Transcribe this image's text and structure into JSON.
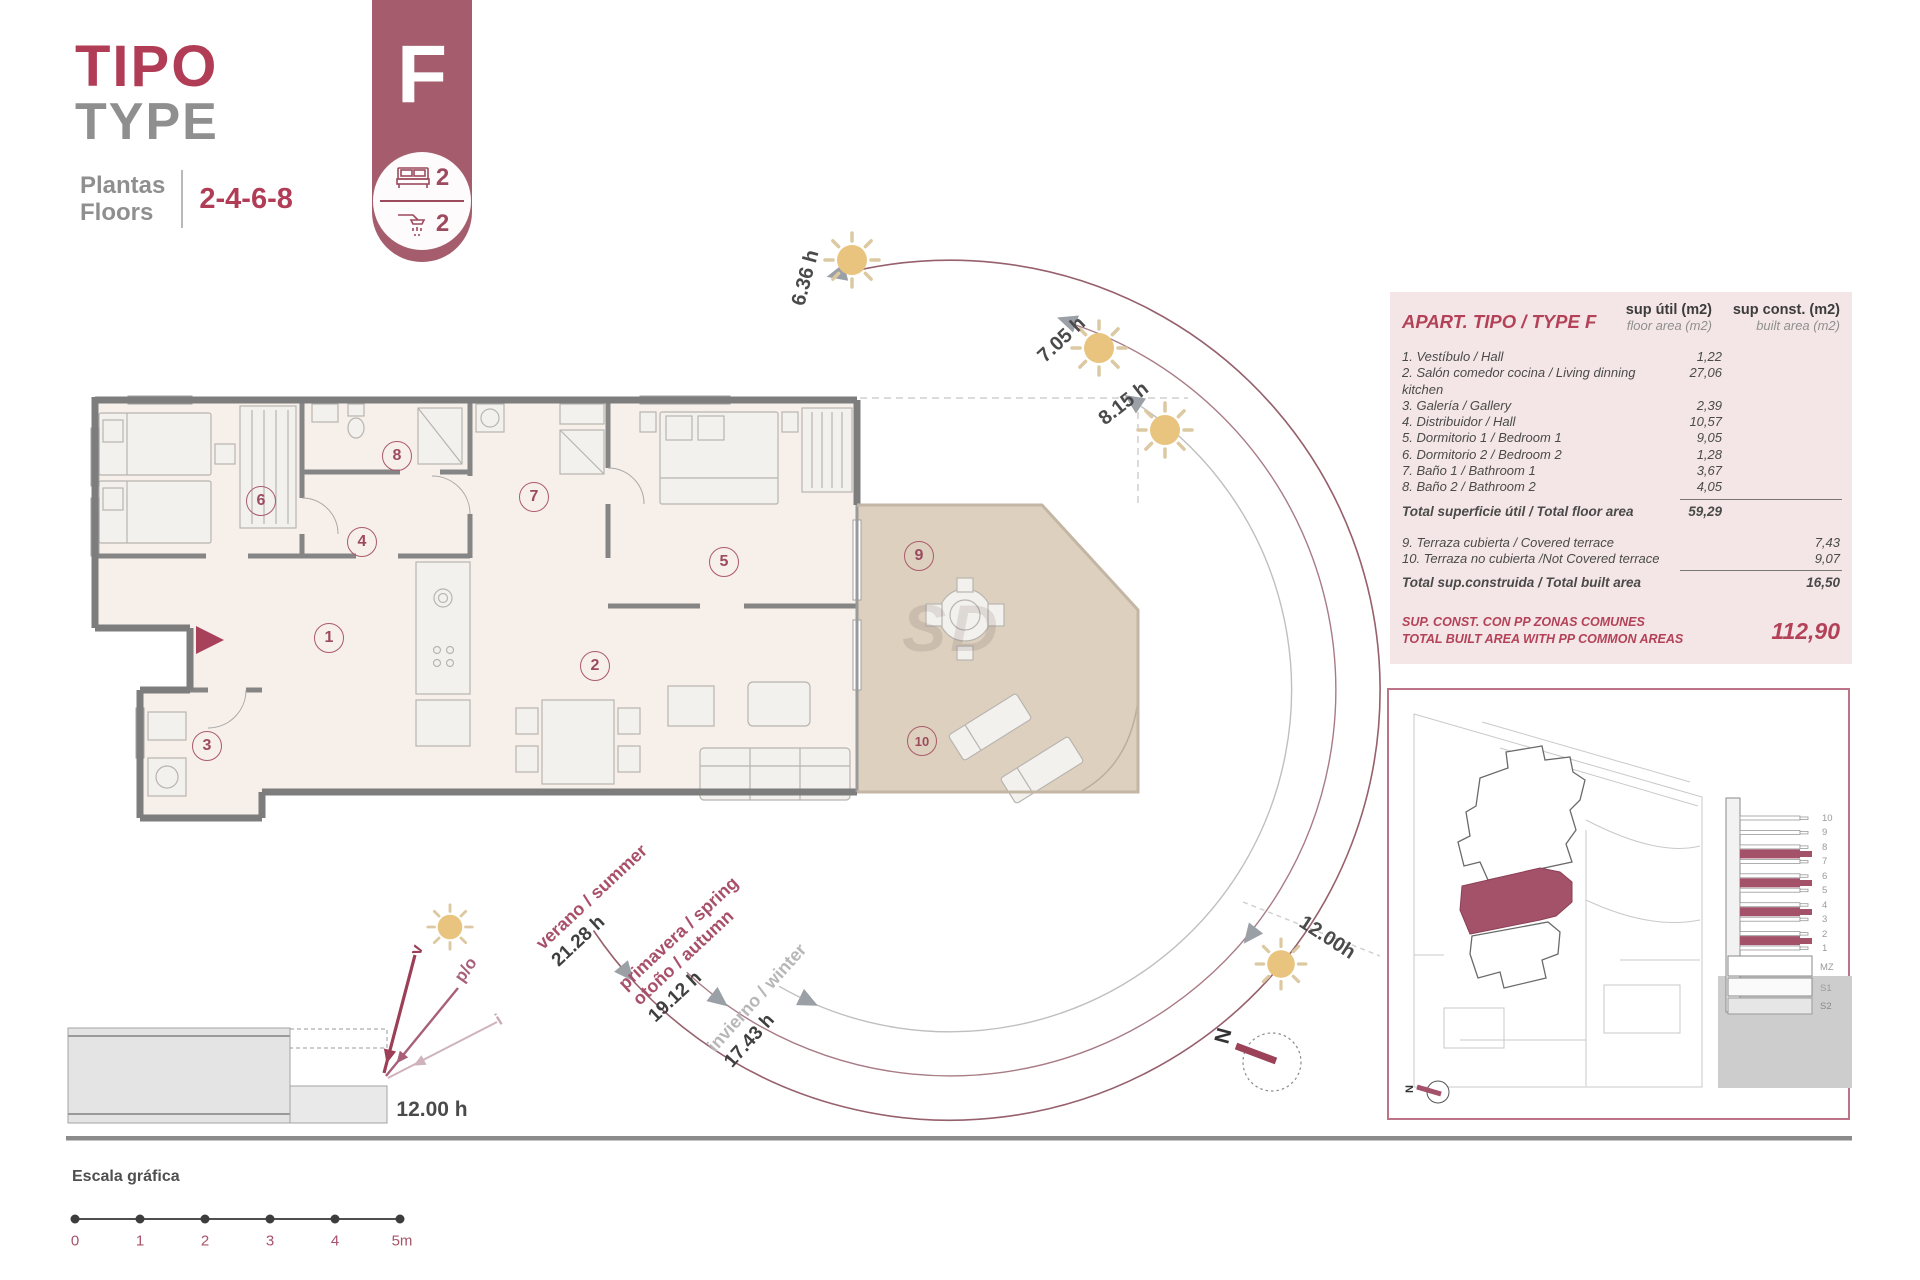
{
  "document": {
    "type_label_es": "TIPO",
    "type_label_en": "TYPE",
    "floors_label_es": "Plantas",
    "floors_label_en": "Floors",
    "floors_value": "2-4-6-8"
  },
  "badge": {
    "letter": "F",
    "bedrooms": "2",
    "bathrooms": "2"
  },
  "floor_plan": {
    "rooms": [
      "1",
      "2",
      "3",
      "4",
      "5",
      "6",
      "7",
      "8",
      "9",
      "10"
    ],
    "watermark": "SD"
  },
  "sun_path": {
    "time_labels": [
      "6.36 h",
      "7.05 h",
      "8.15 h",
      "12.00h"
    ],
    "seasons": [
      {
        "name": "verano / summer",
        "hours": "21.28 h"
      },
      {
        "name": "primavera / spring",
        "name2": "otoño / autumn",
        "hours": "19.12 h"
      },
      {
        "name": "invierno / winter",
        "hours": "17.43 h"
      }
    ]
  },
  "section_diagram": {
    "label_summer": "v",
    "label_spring_autumn": "p/o",
    "label_winter": "i",
    "time": "12.00 h"
  },
  "area_table": {
    "title": "APART. TIPO / TYPE F",
    "col_floor_header": "sup útil (m2)",
    "col_floor_subheader": "floor area (m2)",
    "col_built_header": "sup const. (m2)",
    "col_built_subheader": "built area (m2)",
    "rows": [
      {
        "label": "1. Vestíbulo / Hall",
        "floor": "1,22"
      },
      {
        "label": "2. Salón comedor cocina / Living dinning kitchen",
        "floor": "27,06"
      },
      {
        "label": "3. Galería / Gallery",
        "floor": "2,39"
      },
      {
        "label": "4. Distribuidor / Hall",
        "floor": "10,57"
      },
      {
        "label": "5. Dormitorio 1 / Bedroom 1",
        "floor": "9,05"
      },
      {
        "label": "6. Dormitorio 2 / Bedroom 2",
        "floor": "1,28"
      },
      {
        "label": "7. Baño 1 / Bathroom 1",
        "floor": "3,67"
      },
      {
        "label": "8. Baño 2 / Bathroom 2",
        "floor": "4,05"
      }
    ],
    "total_floor": {
      "label": "Total superficie útil / Total floor area",
      "value": "59,29"
    },
    "terrace_rows": [
      {
        "label": "9. Terraza cubierta / Covered terrace",
        "built": "7,43"
      },
      {
        "label": "10. Terraza no cubierta /Not Covered terrace",
        "built": "9,07"
      }
    ],
    "total_built": {
      "label": "Total sup.construida / Total built area",
      "value": "16,50"
    },
    "common_area": {
      "label_es": "SUP. CONST. CON PP ZONAS COMUNES",
      "label_en": "TOTAL BUILT AREA WITH PP COMMON AREAS",
      "value": "112,90"
    }
  },
  "site_plan": {
    "floor_labels": [
      "10",
      "9",
      "8",
      "7",
      "6",
      "5",
      "4",
      "3",
      "2",
      "1",
      "MZ",
      "S1",
      "S2"
    ],
    "north_label": "N"
  },
  "compass": {
    "north_label": "N"
  },
  "scale_bar": {
    "title": "Escala gráfica",
    "ticks": [
      "0",
      "1",
      "2",
      "3",
      "4",
      "5m"
    ]
  }
}
